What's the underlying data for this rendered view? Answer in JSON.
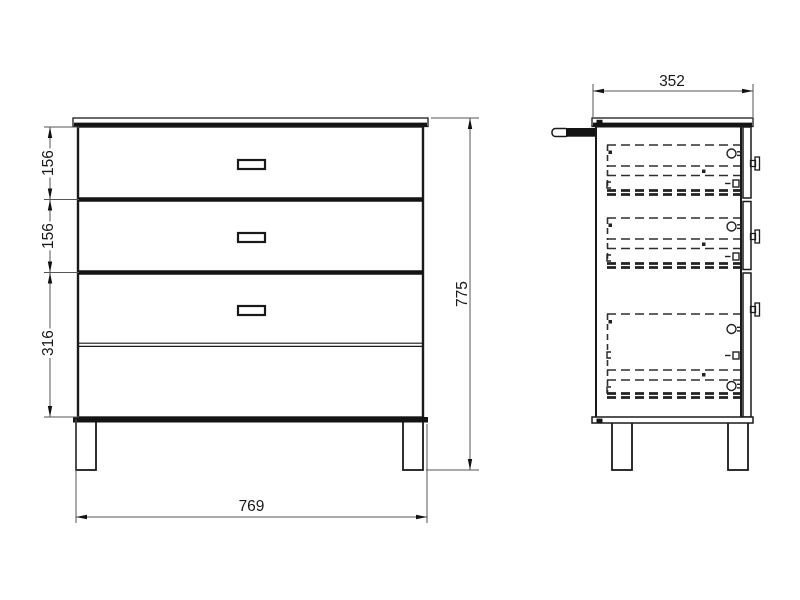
{
  "dimension_labels": {
    "drawer1_height": "156",
    "drawer2_height": "156",
    "bottom_drawer_height": "316",
    "overall_height": "775",
    "overall_width": "769",
    "side_depth": "352"
  },
  "colors": {
    "background": "#ffffff",
    "outline": "#1a1a1a",
    "hidden_detail": "#2e2e2e",
    "dimension_line": "#555555",
    "arrow": "#111111"
  }
}
